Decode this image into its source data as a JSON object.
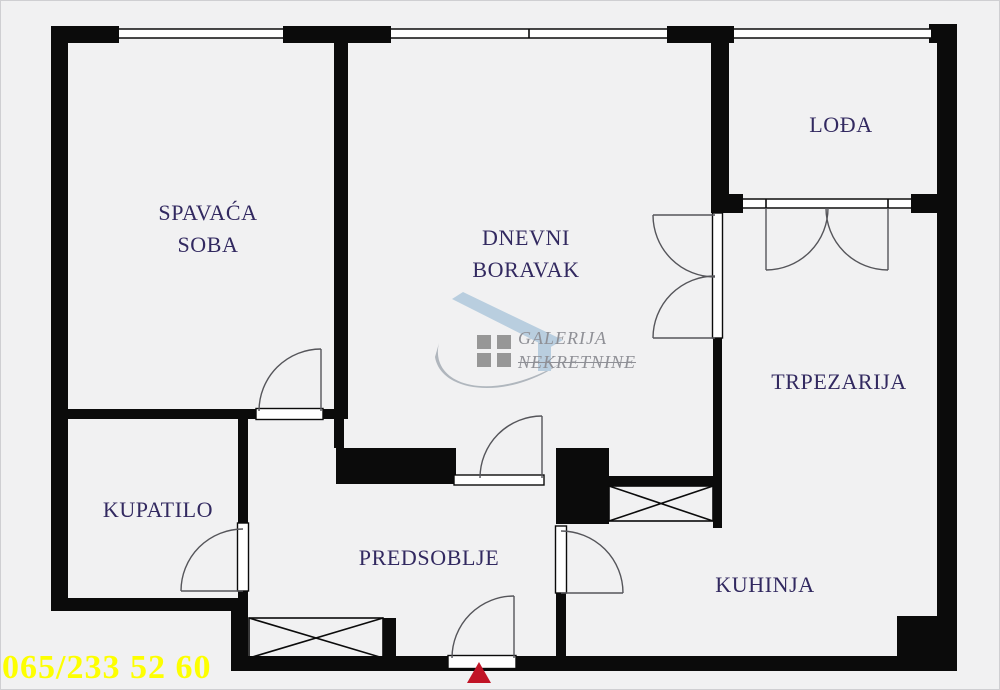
{
  "rooms": {
    "spavaca_soba": {
      "line1": "SPAVAĆA",
      "line2": "SOBA"
    },
    "dnevni_boravak": {
      "line1": "DNEVNI",
      "line2": "BORAVAK"
    },
    "lodja": {
      "label": "LOĐA"
    },
    "trpezarija": {
      "label": "TRPEZARIJA"
    },
    "kupatilo": {
      "label": "KUPATILO"
    },
    "predsoblje": {
      "label": "PREDSOBLJE"
    },
    "kuhinja": {
      "label": "KUHINJA"
    }
  },
  "watermark": {
    "line1": "GALERIJA",
    "line2": "NEKRETNINE"
  },
  "phone": "065/233 52 60",
  "colors": {
    "floor": "#f1f1f2",
    "wall": "#0b0b0b",
    "label": "#322960",
    "phone": "#fdff00",
    "entrance_marker": "#c11426",
    "door_stroke": "#55555a",
    "watermark_text": "#8f9096",
    "watermark_blue": "#b3cbdd",
    "watermark_gray": "#a9b0b8",
    "watermark_squares": "#8e8e8e"
  }
}
